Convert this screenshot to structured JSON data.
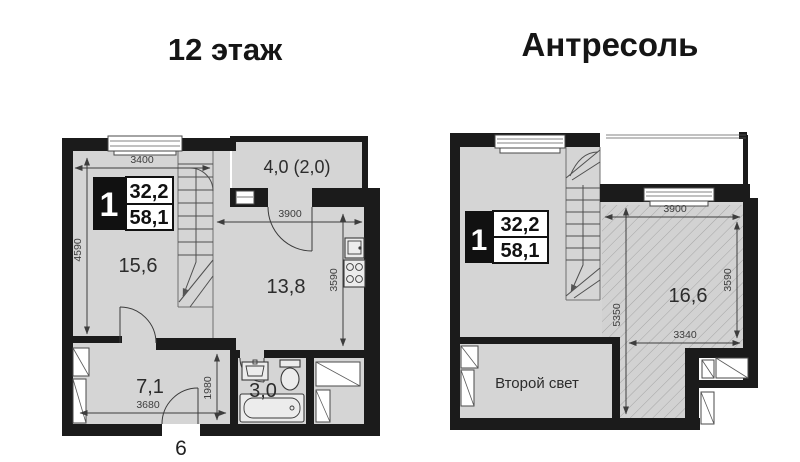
{
  "floor12": {
    "title": "12 этаж",
    "badge": {
      "number": "1",
      "value_top": "32,2",
      "value_bottom": "58,1"
    },
    "rooms": {
      "living": "15,6",
      "kitchen_living": "13,8",
      "hallway": "7,1",
      "bathroom": "3,0",
      "balcony": "4,0 (2,0)"
    },
    "dimensions": {
      "top_width": "3400",
      "left_height": "4590",
      "kitchen_width": "3900",
      "kitchen_height": "3590",
      "hall_height": "1980",
      "hall_width": "3680"
    },
    "apartment_number": "6"
  },
  "mezzanine": {
    "title": "Антресоль",
    "badge": {
      "number": "1",
      "value_top": "32,2",
      "value_bottom": "58,1"
    },
    "rooms": {
      "mezzanine_room": "16,6",
      "void": "Второй свет"
    },
    "dimensions": {
      "top_width": "3900",
      "right_height": "3590",
      "left_height": "5350",
      "bottom_width": "3340"
    }
  },
  "colors": {
    "wall": "#1b1b1b",
    "floor": "#d5d5d5",
    "hatch_line": "#a6a6a6",
    "dimension_text": "#3d3d3d",
    "title_text": "#151515",
    "background": "#ffffff"
  }
}
